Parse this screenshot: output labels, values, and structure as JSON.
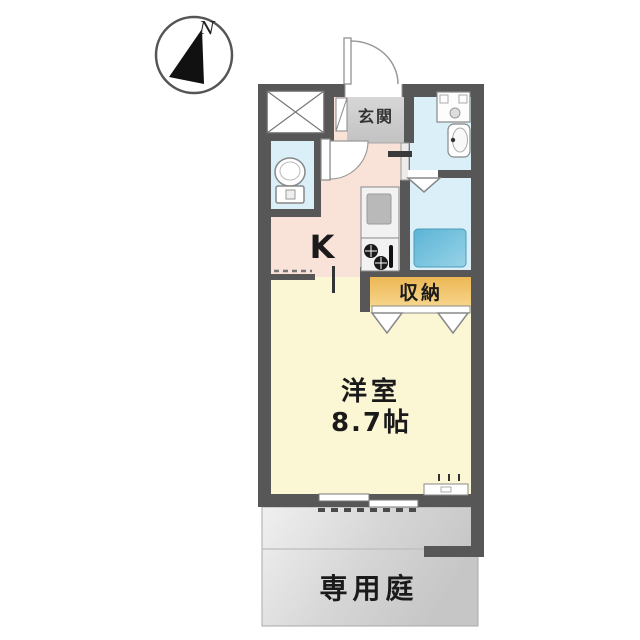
{
  "compass": {
    "north_label": "N"
  },
  "rooms": {
    "entrance": {
      "label": "玄関"
    },
    "kitchen": {
      "label": "K"
    },
    "closet": {
      "label": "収納"
    },
    "main_room": {
      "label": "洋室",
      "size": "8.7帖"
    },
    "garden": {
      "label": "専用庭"
    }
  },
  "colors": {
    "wall": "#575757",
    "kitchen-floor": "#f9e2d8",
    "room-floor": "#fbf6d3",
    "wet-floor": "#daeff8",
    "entrance-floor": "#cbcbcb",
    "closet-fill": "#f0c068",
    "bathtub-fill": "#66bad8",
    "garden-fill": "#d9d9d9"
  }
}
